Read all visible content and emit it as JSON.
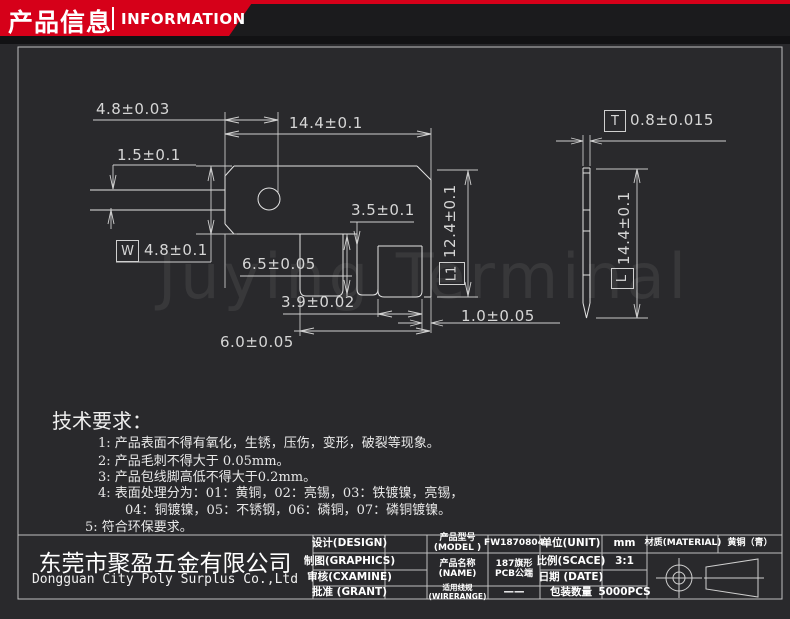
{
  "header": {
    "title_cn": "产品信息",
    "title_en": "INFORMATION"
  },
  "watermark": "Juying Terminal",
  "dims": {
    "top_offset": "4.8±0.03",
    "total_width": "14.4±0.1",
    "blade_thickness": "1.5±0.1",
    "w_label": "W",
    "w_value": "4.8±0.1",
    "step": "3.5±0.1",
    "leg_length": "6.5±0.05",
    "leg_width": "3.9±0.02",
    "leg_span": "6.0±0.05",
    "edge_gap": "1.0±0.05",
    "l1_label": "L1",
    "body_height": "12.4±0.1",
    "t_label": "T",
    "thickness": "0.8±0.015",
    "l_label": "L",
    "total_length": "14.4±0.1"
  },
  "requirements": {
    "title": "技术要求：",
    "lines": [
      "1: 产品表面不得有氧化，生锈，压伤，变形，破裂等现象。",
      "2: 产品毛刺不得大于 0.05mm。",
      "3: 产品包线脚高低不得大于0.2mm。",
      "4: 表面处理分为：01：黄铜，02：亮锡，03：铁镀镍，亮锡，",
      "04：铜镀镍，05：不锈钢，06：磷铜，07：磷铜镀镍。",
      "5: 符合环保要求。"
    ]
  },
  "company": {
    "name_cn": "东莞市聚盈五金有限公司",
    "name_en": "Dongguan City Poly Surplus Co.,Ltd"
  },
  "titleblock": {
    "design_label": "设计(DESIGN)",
    "graphics_label": "制图(GRAPHICS)",
    "examine_label": "审核(CXAMINE)",
    "grant_label": "批准 (GRANT)",
    "model_label_cn": "产品型号",
    "model_label_en": "(MODEL )",
    "model_value": "FW1870804",
    "name_label_cn": "产品名称",
    "name_label_en": "(NAME)",
    "name_value_line1": "187旗形",
    "name_value_line2": "PCB公端",
    "wire_label_cn": "适用线规",
    "wire_label_en": "(WIRERANGE)",
    "wire_value": "——",
    "unit_label": "单位(UNIT)",
    "unit_value": "mm",
    "scale_label": "比例(SCACE)",
    "scale_value": "3:1",
    "date_label": "日期 (DATE)",
    "date_value": "",
    "qty_label": "包装数量",
    "qty_value": "5000PCS",
    "material_label": "材质(MATERIAL)",
    "material_value": "黄铜（青）"
  },
  "colors": {
    "accent_red": "#d60019",
    "line": "#dedede",
    "background": "#29292c"
  }
}
